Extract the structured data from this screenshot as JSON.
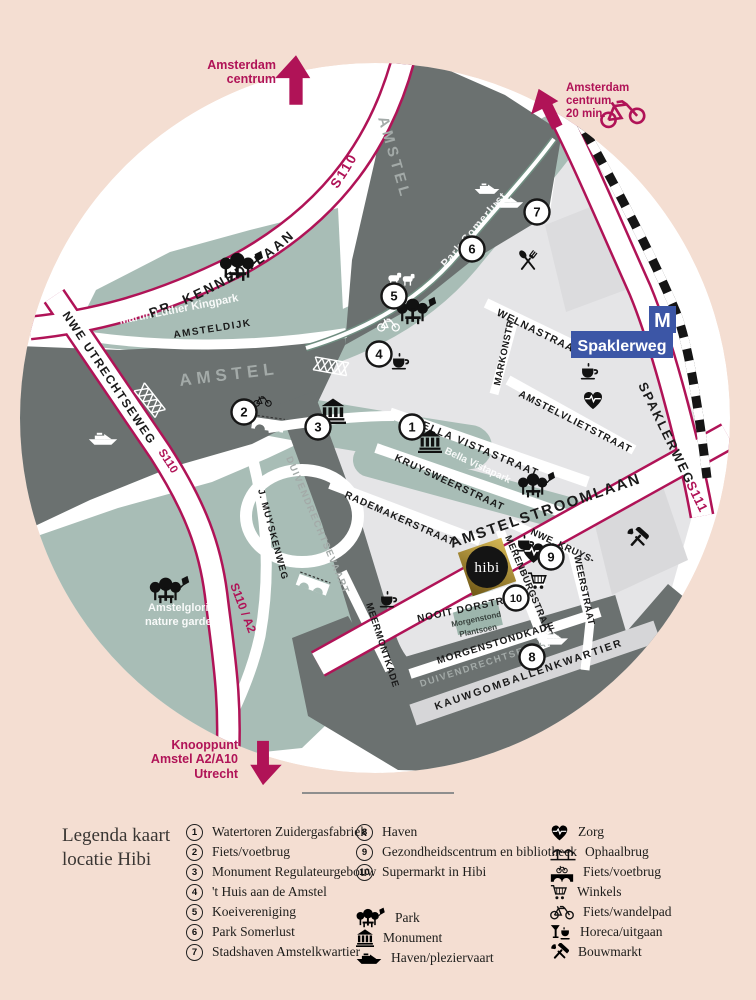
{
  "arrows": {
    "top": {
      "label": "Amsterdam\ncentrum"
    },
    "top_right": {
      "label": "Amsterdam\ncentrum\n20 min."
    },
    "bottom": {
      "label": "Knooppunt\nAmstel A2/A10\nUtrecht"
    }
  },
  "metro": {
    "m": "M",
    "station": "Spaklerweg"
  },
  "hibi_logo": "hibi",
  "map": {
    "labels": {
      "pr_kennedylaan": "PR. KENNEDYLAAN",
      "s110_kennedy": "S110",
      "nwe_utrechtseweg": "NWE UTRECHTSEWEG",
      "s110": "S110",
      "s110_a2": "S110 / A2",
      "j_muyskenweg": "J. MUYSKENWEG",
      "amsteldijk": "AMSTELDIJK",
      "amstel_left": "AMSTEL",
      "amstel_top": "AMSTEL",
      "martin_luther_kingpark": "Martin Luther Kingpark",
      "park_somerlust": "Park Somerlust",
      "welnastraat": "WELNASTRAAT",
      "markonstr": "MARKONSTR.",
      "amstelvlietstraat": "AMSTELVLIETSTRAAT",
      "bella_vistastraat": "BELLA VISTASTRAAT",
      "bella_vistapark": "Bella Vistapark",
      "kruysweerstraat": "KRUYSWEERSTRAAT",
      "rademakerstraat": "RADEMAKERSTRAAT",
      "duivendrechtsevaart_1": "DUIVENDRECHTSEVAART",
      "duivendrechtsevaart_2": "DUIVENDRECHTSEVAART",
      "amstelstroomlaan": "AMSTELSTROOMLAAN",
      "spaklerweg_road": "SPAKLERWEG",
      "s111": "S111",
      "merenburgstraat": "MERENBURGSTRAAT",
      "nwe_kruys_1": "NWE. KRUYS-",
      "nwe_kruys_2": "WEERSTRAAT",
      "nooit_dorstraat": "NOOIT DORSTRAAT",
      "morgenstond_1": "Morgenstond",
      "morgenstond_2": "Plantsoen",
      "morgenstondkade": "MORGENSTONDKADE",
      "meermontkade": "MEERMONTKADE",
      "kauwgomballenkwartier": "KAUWGOMBALLENKWARTIER",
      "amstelglorie_1": "Amstelglorie",
      "amstelglorie_2": "nature garden"
    },
    "markers": [
      "1",
      "2",
      "3",
      "4",
      "5",
      "6",
      "7",
      "8",
      "9",
      "10"
    ]
  },
  "legend": {
    "title": "Legenda kaart\nlocatie Hibi",
    "numbered": [
      {
        "num": "1",
        "label": "Watertoren Zuidergasfabriek"
      },
      {
        "num": "2",
        "label": "Fiets/voetbrug"
      },
      {
        "num": "3",
        "label": "Monument Regulateurgebouw"
      },
      {
        "num": "4",
        "label": "'t Huis aan de Amstel"
      },
      {
        "num": "5",
        "label": "Koeivereniging"
      },
      {
        "num": "6",
        "label": "Park Somerlust"
      },
      {
        "num": "7",
        "label": "Stadshaven Amstelkwartier"
      },
      {
        "num": "8",
        "label": "Haven"
      },
      {
        "num": "9",
        "label": "Gezondheidscentrum en bibliotheek"
      },
      {
        "num": "10",
        "label": "Supermarkt in Hibi"
      }
    ],
    "symbols": [
      {
        "icon": "park-icon",
        "label": "Park"
      },
      {
        "icon": "monument-icon",
        "label": "Monument"
      },
      {
        "icon": "boat-icon",
        "label": "Haven/pleziervaart"
      },
      {
        "icon": "zorg-icon",
        "label": "Zorg"
      },
      {
        "icon": "ophaalbrug-icon",
        "label": "Ophaalbrug"
      },
      {
        "icon": "fietsbrug-icon",
        "label": "Fiets/voetbrug"
      },
      {
        "icon": "winkels-icon",
        "label": "Winkels"
      },
      {
        "icon": "fietspad-icon",
        "label": "Fiets/wandelpad"
      },
      {
        "icon": "horeca-icon",
        "label": "Horeca/uitgaan"
      },
      {
        "icon": "bouwmarkt-icon",
        "label": "Bouwmarkt"
      }
    ]
  },
  "colors": {
    "background": "#f4ded2",
    "accent_magenta": "#b01357",
    "river": "#6b7170",
    "park_green": "#a8bdb6",
    "block_gray": "#e5e5e7",
    "metro_blue": "#3c56a6",
    "hibi_gold": "#b5953c"
  }
}
